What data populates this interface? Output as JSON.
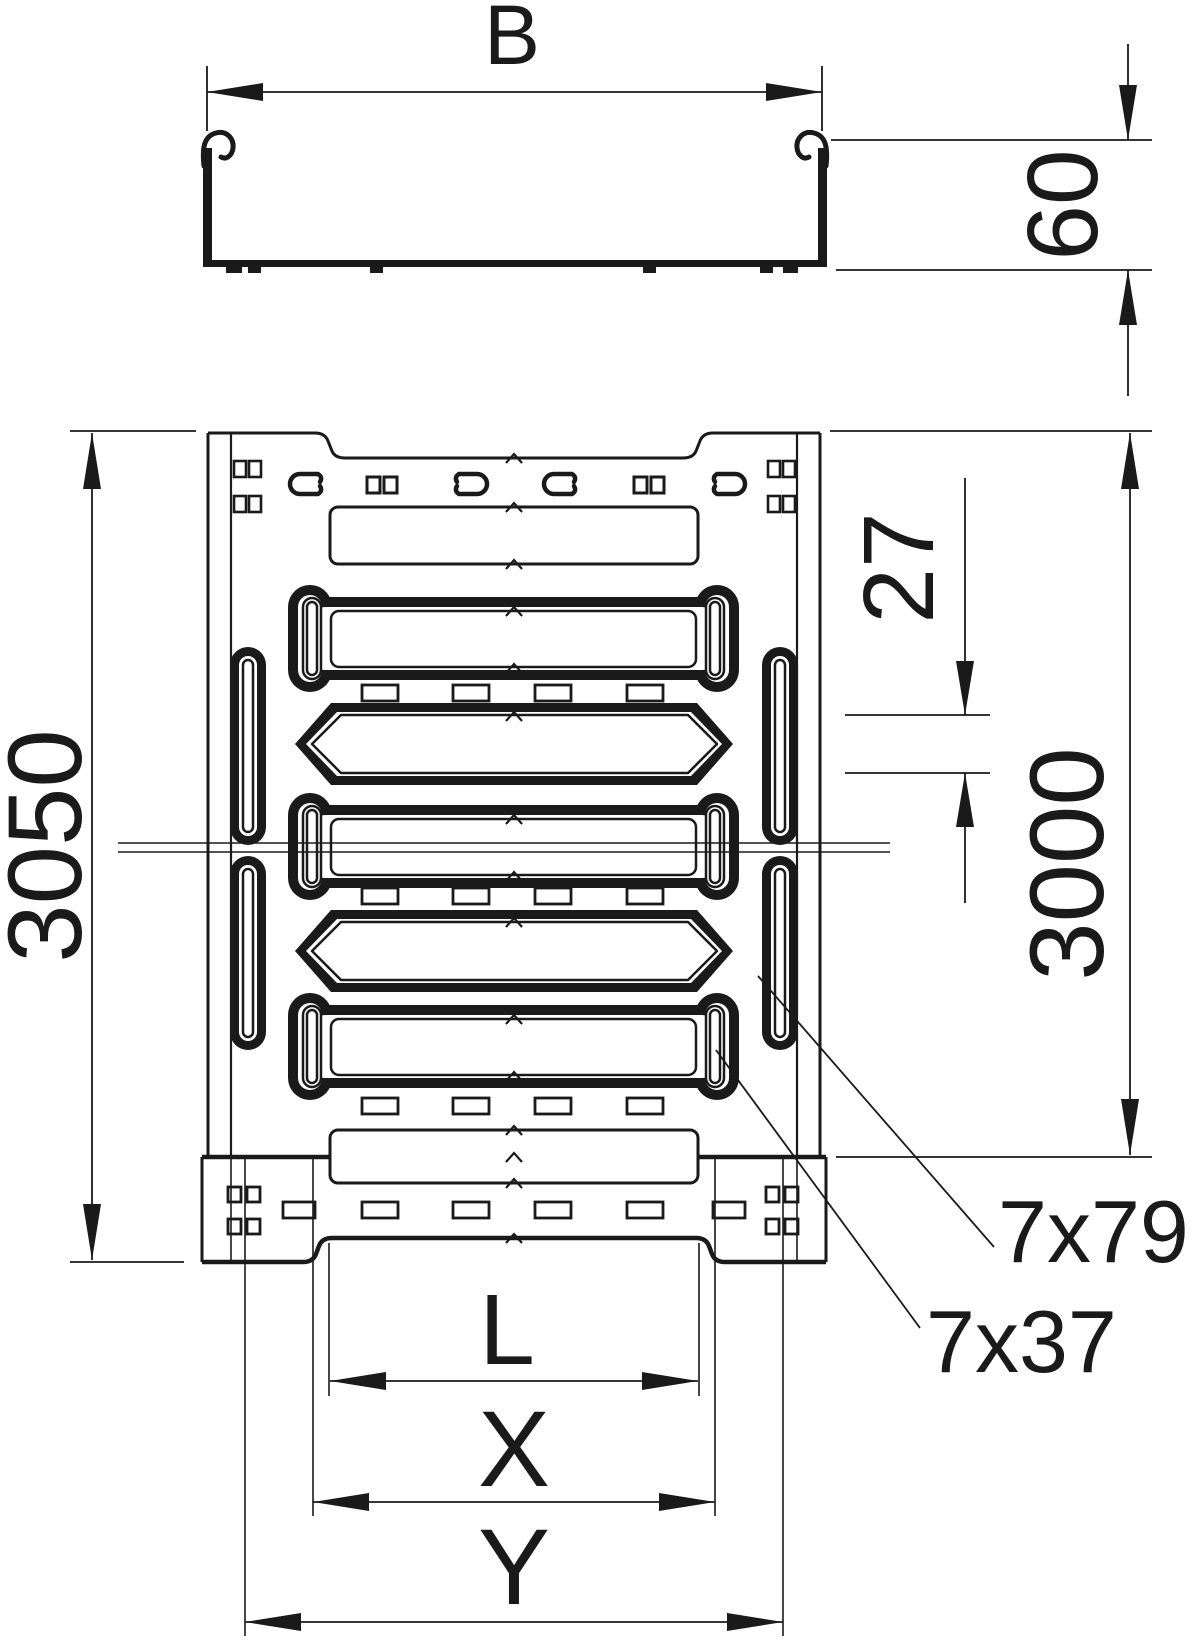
{
  "page": {
    "background": "#ffffff",
    "ink": "#1a1a1a"
  },
  "drawing": {
    "labels": {
      "width": "B",
      "height": "60",
      "overall_length": "3050",
      "tray_length": "3000",
      "slot_height": "27",
      "side_slot": "7x79",
      "bottom_slot": "7x37",
      "l": "L",
      "x": "X",
      "y": "Y"
    }
  }
}
